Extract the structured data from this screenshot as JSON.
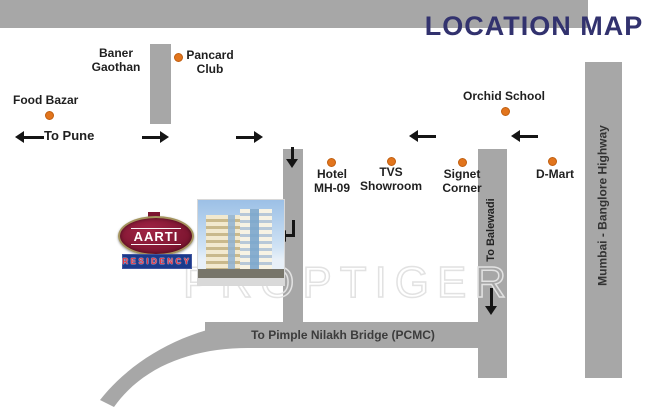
{
  "title": "LOCATION MAP",
  "watermark": "PROPTIGER",
  "logo": {
    "name": "AARTI",
    "subtitle": "RESIDENCY"
  },
  "road_labels": {
    "to_pune": "To Pune",
    "pimple_nilakh": "To Pimple Nilakh Bridge (PCMC)",
    "balewadi": "To Balewadi",
    "highway": "Mumbai - Banglore Highway"
  },
  "places": {
    "baner_gaothan": {
      "line1": "Baner",
      "line2": "Gaothan"
    },
    "pancard_club": {
      "line1": "Pancard",
      "line2": "Club"
    },
    "food_bazar": {
      "name": "Food Bazar"
    },
    "orchid_school": {
      "name": "Orchid School"
    },
    "hotel": {
      "line1": "Hotel",
      "line2": "MH-09"
    },
    "tvs": {
      "line1": "TVS",
      "line2": "Showroom"
    },
    "signet": {
      "line1": "Signet",
      "line2": "Corner"
    },
    "dmart": {
      "name": "D-Mart"
    }
  },
  "colors": {
    "road": "#a7a7a7",
    "title_text": "#32326e",
    "marker": "#e2751d",
    "label_text": "#1f1f1f",
    "logo_maroon": "#7d1530",
    "logo_border": "#a4945e",
    "residency_bg": "#1b3a8c",
    "residency_text": "#e03545",
    "watermark_outline": "#e2e2e2"
  }
}
